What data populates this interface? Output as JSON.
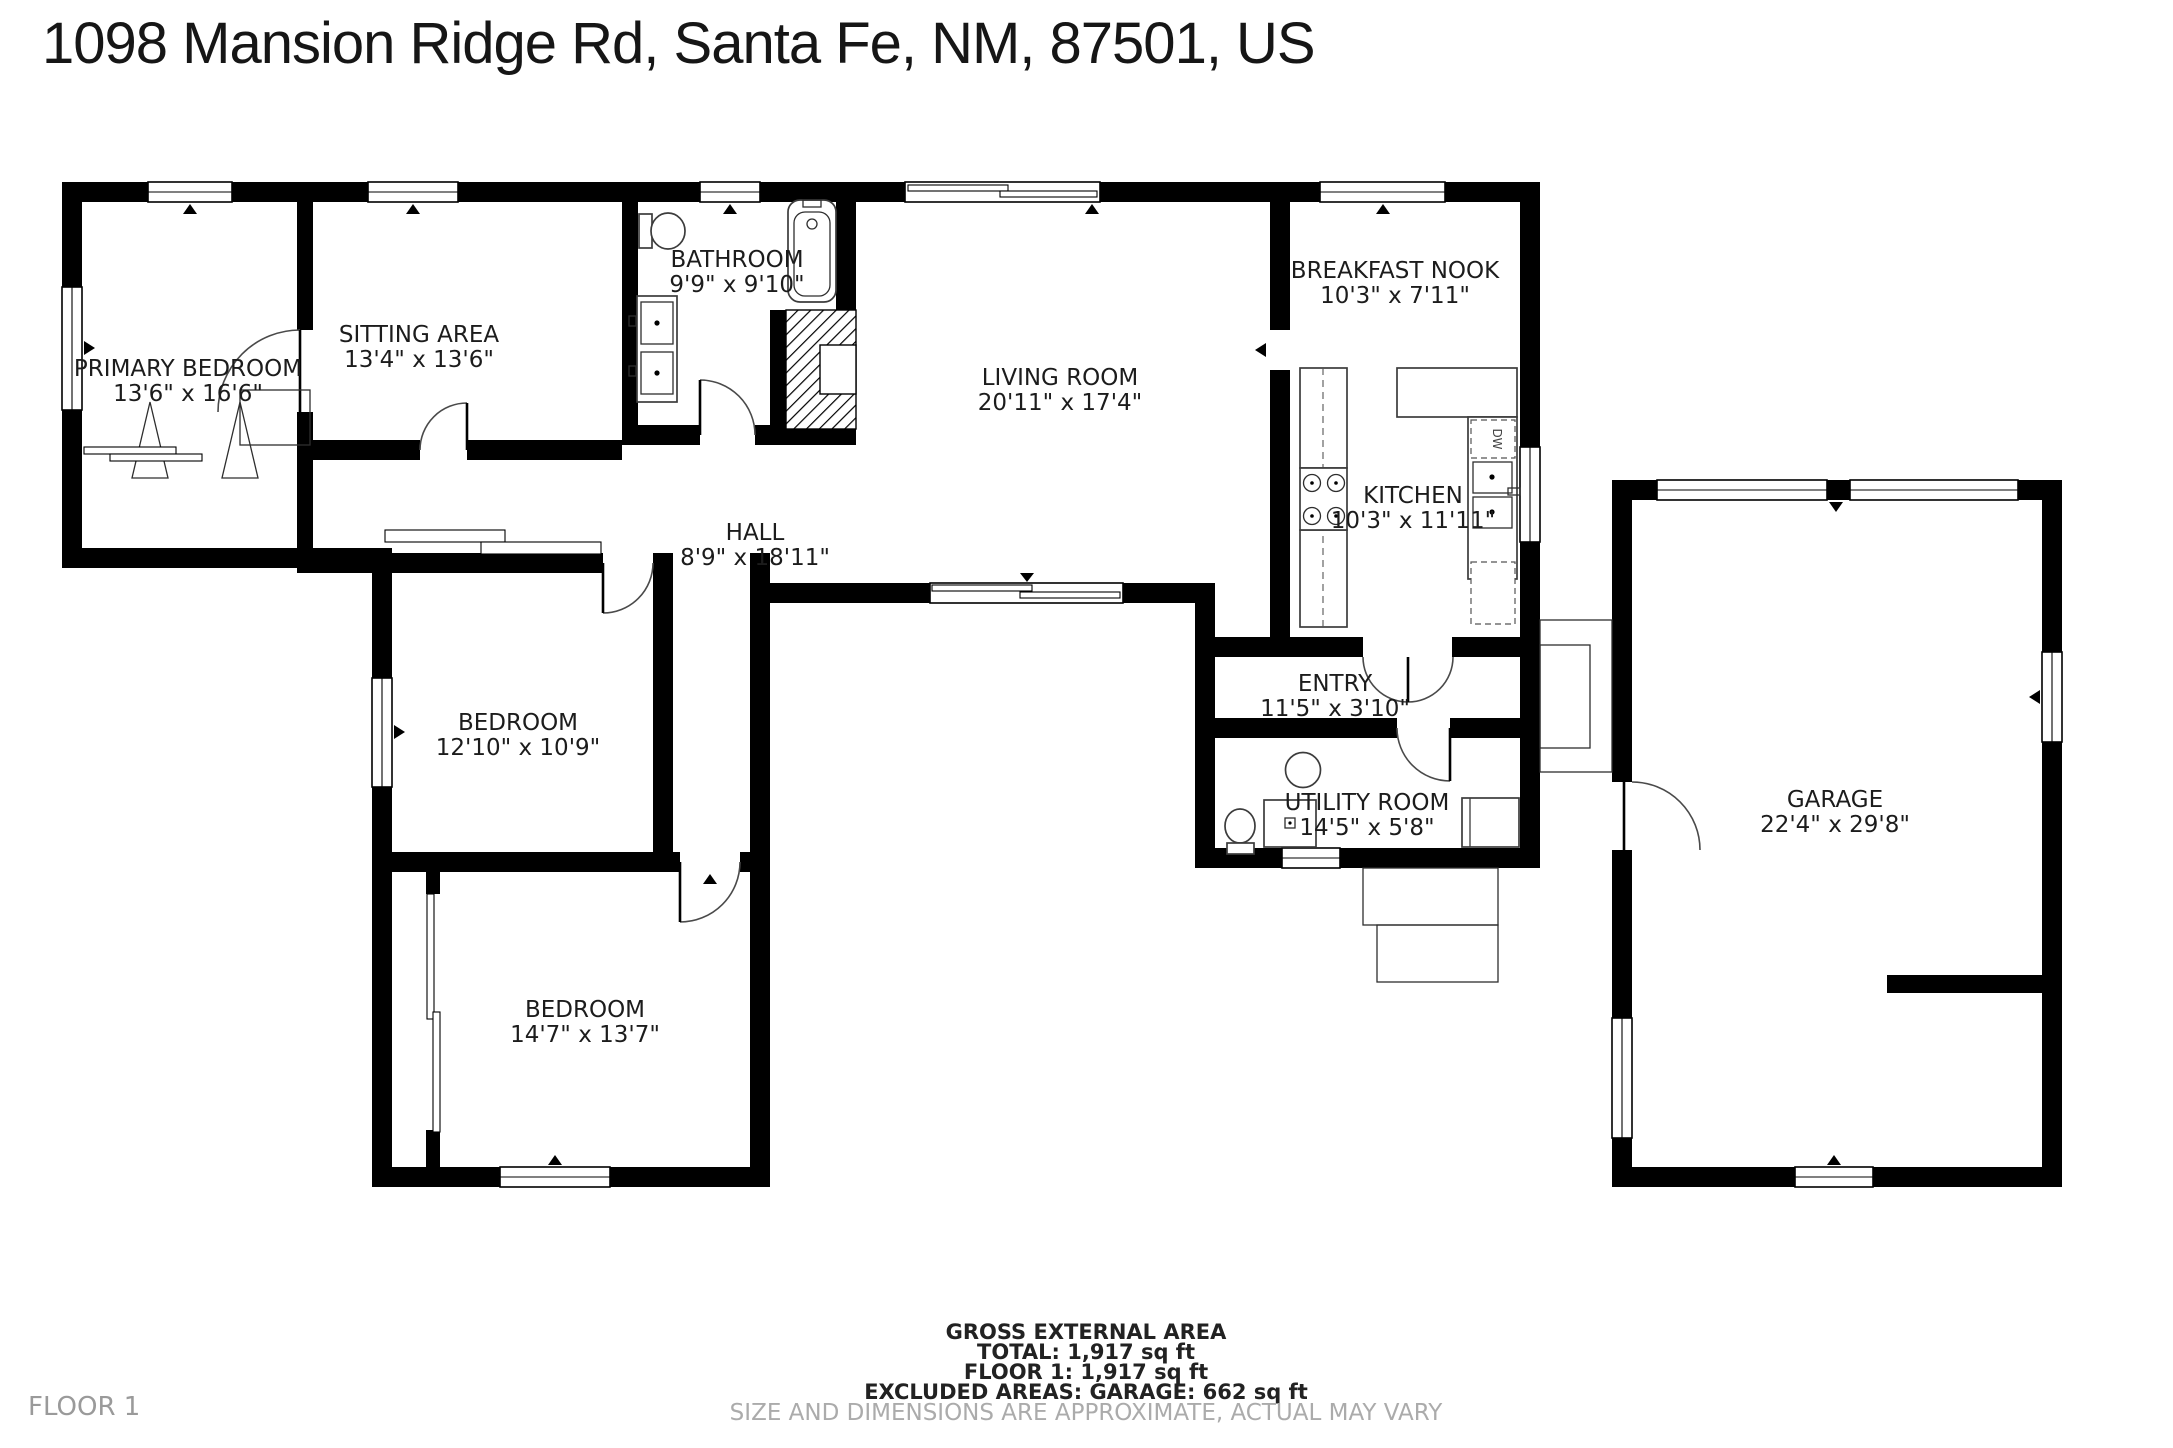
{
  "title": "1098 Mansion Ridge Rd, Santa Fe, NM, 87501, US",
  "floor_label": "FLOOR 1",
  "rooms": [
    {
      "name": "PRIMARY BEDROOM",
      "dims": "13'6\" x 16'6\""
    },
    {
      "name": "SITTING AREA",
      "dims": "13'4\" x 13'6\""
    },
    {
      "name": "BATHROOM",
      "dims": "9'9\" x 9'10\""
    },
    {
      "name": "LIVING ROOM",
      "dims": "20'11\" x 17'4\""
    },
    {
      "name": "BREAKFAST NOOK",
      "dims": "10'3\" x 7'11\""
    },
    {
      "name": "KITCHEN",
      "dims": "10'3\" x 11'11\""
    },
    {
      "name": "HALL",
      "dims": "8'9\" x 18'11\""
    },
    {
      "name": "BEDROOM",
      "dims": "12'10\" x 10'9\""
    },
    {
      "name": "BEDROOM",
      "dims": "14'7\" x 13'7\""
    },
    {
      "name": "ENTRY",
      "dims": "11'5\" x 3'10\""
    },
    {
      "name": "UTILITY ROOM",
      "dims": "14'5\" x 5'8\""
    },
    {
      "name": "GARAGE",
      "dims": "22'4\" x 29'8\""
    }
  ],
  "labels": {
    "dishwasher": "DW"
  },
  "footer": {
    "heading": "GROSS EXTERNAL AREA",
    "total": "TOTAL: 1,917 sq ft",
    "floor1": "FLOOR 1: 1,917 sq ft",
    "excluded": "EXCLUDED AREAS: GARAGE: 662 sq ft",
    "disclaimer": "SIZE AND DIMENSIONS ARE APPROXIMATE, ACTUAL MAY VARY"
  },
  "colors": {
    "wall": "#000000",
    "label": "#1c1c1c",
    "muted": "#ababab",
    "background": "#ffffff"
  }
}
